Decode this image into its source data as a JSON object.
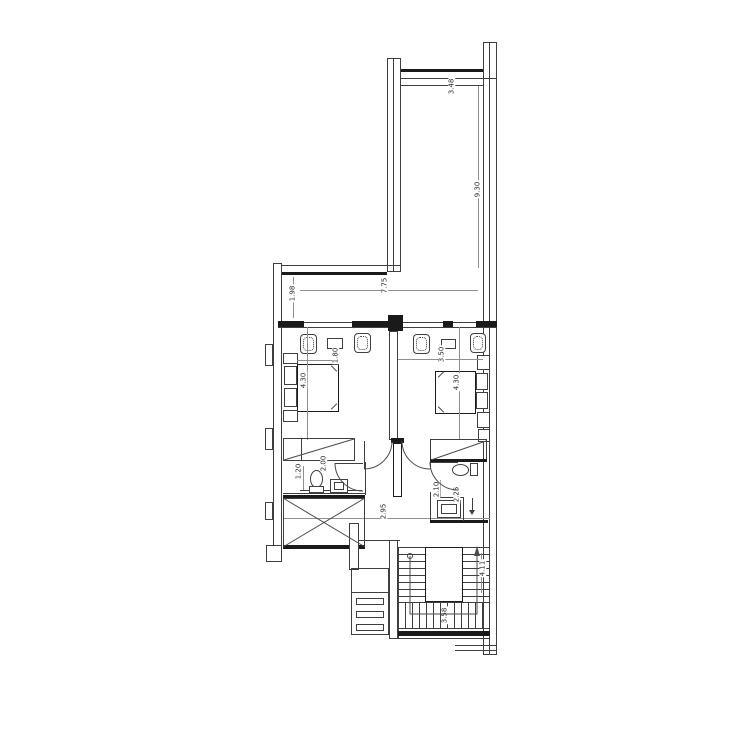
{
  "drawing": {
    "type": "architectural-floor-plan",
    "dimensions": {
      "terrace_top": "3.48",
      "terrace_side": "9.30",
      "balcony_width": "7.75",
      "balcony_depth": "1.98",
      "bed_left_width": "1.80",
      "bed_left_length": "4.30",
      "bed_right_width": "3.50",
      "bed_right_length": "4.30",
      "bath_left_width": "1.20",
      "bath_left_length": "2.00",
      "bath_right_width": "2.10",
      "bath_right_length": "2.25",
      "hall_width": "2.95",
      "stair_length": "4.11",
      "stair_width": "3.58"
    }
  }
}
